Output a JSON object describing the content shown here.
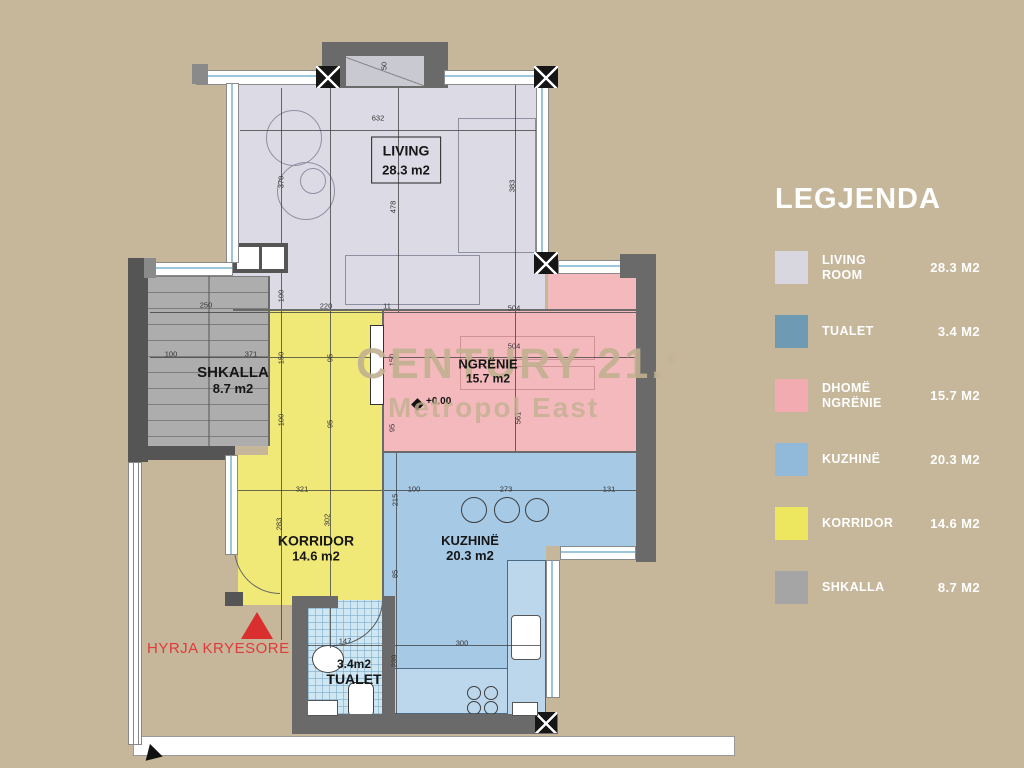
{
  "watermark": {
    "line1": "CENTURY 21.",
    "reg": "®",
    "line2": "Metropol East"
  },
  "legend": {
    "title": "LEGJENDA",
    "items": [
      {
        "label": "LIVING ROOM",
        "value": "28.3 M2",
        "color": "#d8d7df",
        "pattern": "solid"
      },
      {
        "label": "TUALET",
        "value": "3.4 M2",
        "color": "#6f9ab3",
        "pattern": "grid"
      },
      {
        "label": "DHOMË NGRËNIE",
        "value": "15.7 M2",
        "color": "#f2abb1",
        "pattern": "solid"
      },
      {
        "label": "KUZHINË",
        "value": "20.3 M2",
        "color": "#90b9da",
        "pattern": "solid"
      },
      {
        "label": "KORRIDOR",
        "value": "14.6 M2",
        "color": "#ece75f",
        "pattern": "solid"
      },
      {
        "label": "SHKALLA",
        "value": "8.7 M2",
        "color": "#a5a5a5",
        "pattern": "solid"
      }
    ]
  },
  "rooms": {
    "living": {
      "name": "LIVING",
      "area": "28.3 m2"
    },
    "shkalla": {
      "name": "SHKALLA",
      "area": "8.7 m2"
    },
    "ngrenie": {
      "name": "NGRËNIE",
      "area": "15.7 m2"
    },
    "korridor": {
      "name": "KORRIDOR",
      "area": "14.6 m2"
    },
    "kuzhine": {
      "name": "KUZHINË",
      "area": "20.3 m2"
    },
    "tualet": {
      "name": "TUALET",
      "area": "3.4m2"
    }
  },
  "entrance": {
    "label": "HYRJA KRYESORE"
  },
  "level_marker": "+0.00",
  "colors": {
    "background": "#c6b69a",
    "living": "#dcdbe5",
    "dining": "#f4b9bd",
    "kitchen": "#a6c9e5",
    "corridor": "#f0e977",
    "stairs": "#adadad",
    "toilet": "#cfe7f3",
    "wall": "#6a6a6a",
    "accent_red": "#e03a3a",
    "legend_text": "#ffffff",
    "watermark": "#c1ac88"
  },
  "dimensions": [
    {
      "t": "632",
      "x": 378,
      "y": 118
    },
    {
      "t": "370",
      "x": 281,
      "y": 182,
      "v": 1
    },
    {
      "t": "478",
      "x": 393,
      "y": 207,
      "v": 1
    },
    {
      "t": "383",
      "x": 512,
      "y": 186,
      "v": 1
    },
    {
      "t": "50",
      "x": 384,
      "y": 66,
      "v": 1
    },
    {
      "t": "250",
      "x": 206,
      "y": 305
    },
    {
      "t": "100",
      "x": 171,
      "y": 354
    },
    {
      "t": "371",
      "x": 251,
      "y": 354
    },
    {
      "t": "220",
      "x": 326,
      "y": 306
    },
    {
      "t": "11",
      "x": 387,
      "y": 306
    },
    {
      "t": "100",
      "x": 281,
      "y": 296,
      "v": 1
    },
    {
      "t": "150",
      "x": 281,
      "y": 358,
      "v": 1
    },
    {
      "t": "95",
      "x": 330,
      "y": 358,
      "v": 1
    },
    {
      "t": "100",
      "x": 281,
      "y": 420,
      "v": 1
    },
    {
      "t": "95",
      "x": 330,
      "y": 424,
      "v": 1
    },
    {
      "t": "504",
      "x": 514,
      "y": 308
    },
    {
      "t": "504",
      "x": 514,
      "y": 346
    },
    {
      "t": "150",
      "x": 392,
      "y": 360,
      "v": 1
    },
    {
      "t": "561",
      "x": 518,
      "y": 418,
      "v": 1
    },
    {
      "t": "95",
      "x": 392,
      "y": 428,
      "v": 1
    },
    {
      "t": "321",
      "x": 302,
      "y": 489
    },
    {
      "t": "283",
      "x": 279,
      "y": 524,
      "v": 1
    },
    {
      "t": "302",
      "x": 327,
      "y": 520,
      "v": 1
    },
    {
      "t": "215",
      "x": 395,
      "y": 500,
      "v": 1
    },
    {
      "t": "100",
      "x": 414,
      "y": 489
    },
    {
      "t": "273",
      "x": 506,
      "y": 489
    },
    {
      "t": "131",
      "x": 609,
      "y": 489
    },
    {
      "t": "85",
      "x": 395,
      "y": 574,
      "v": 1
    },
    {
      "t": "147",
      "x": 345,
      "y": 641
    },
    {
      "t": "239",
      "x": 394,
      "y": 661,
      "v": 1
    },
    {
      "t": "300",
      "x": 462,
      "y": 643
    }
  ]
}
